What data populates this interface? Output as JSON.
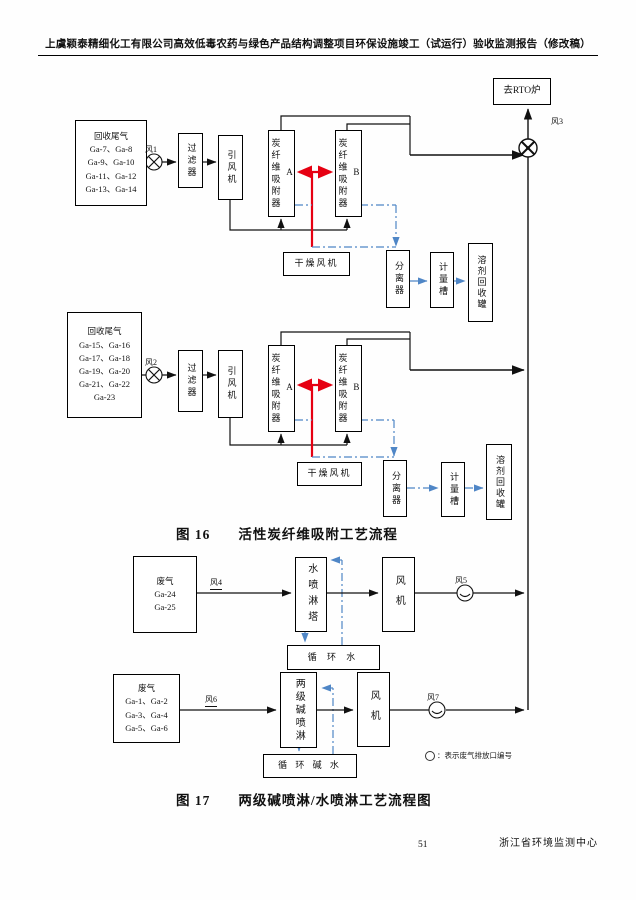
{
  "hdr": {
    "title": "上虞颖泰精细化工有限公司高效低毒农药与绿色产品结构调整项目环保设施竣工（试运行）验收监测报告（修改稿）"
  },
  "fig16": {
    "cap_no": "图 16",
    "cap_title": "活性炭纤维吸附工艺流程",
    "rto": "去RTO炉",
    "fan3": "风3",
    "u1": {
      "src": "回收尾气\nGa-7、Ga-8\nGa-9、Ga-10\nGa-11、Ga-12\nGa-13、Ga-14",
      "fan": "风1",
      "filter": "过滤器",
      "blower": "引风机",
      "adsA": "炭纤维吸附器A",
      "adsB": "炭纤维吸附器B",
      "dry": "干燥风机",
      "sep": "分离器",
      "meter": "计量槽",
      "rec": "溶剂回收罐"
    },
    "u2": {
      "src": "回收尾气\nGa-15、Ga-16\nGa-17、Ga-18\nGa-19、Ga-20\nGa-21、Ga-22\nGa-23",
      "fan": "风2",
      "filter": "过滤器",
      "blower": "引风机",
      "adsA": "炭纤维吸附器A",
      "adsB": "炭纤维吸附器B",
      "dry": "干燥风机",
      "sep": "分离器",
      "meter": "计量槽",
      "rec": "溶剂回收罐"
    }
  },
  "fig17": {
    "cap_no": "图 17",
    "cap_title": "两级碱喷淋/水喷淋工艺流程图",
    "water": {
      "src": "废气\nGa-24\nGa-25",
      "duct": "风4",
      "tower": "水喷淋塔",
      "fan": "风机",
      "tank": "循 环 水",
      "outlet": "风5"
    },
    "alkali": {
      "src": "废气\nGa-1、Ga-2\nGa-3、Ga-4\nGa-5、Ga-6",
      "duct": "风6",
      "tower": "两级碱喷淋",
      "fan": "风机",
      "tank": "循 环 碱 水",
      "outlet": "风7"
    },
    "legend": "：表示废气排放口编号"
  },
  "ftr": {
    "page_number": "51",
    "org": "浙江省环境监测中心"
  },
  "colors": {
    "line": "#111111",
    "red": "#e60012",
    "blue": "#4f86c6"
  }
}
